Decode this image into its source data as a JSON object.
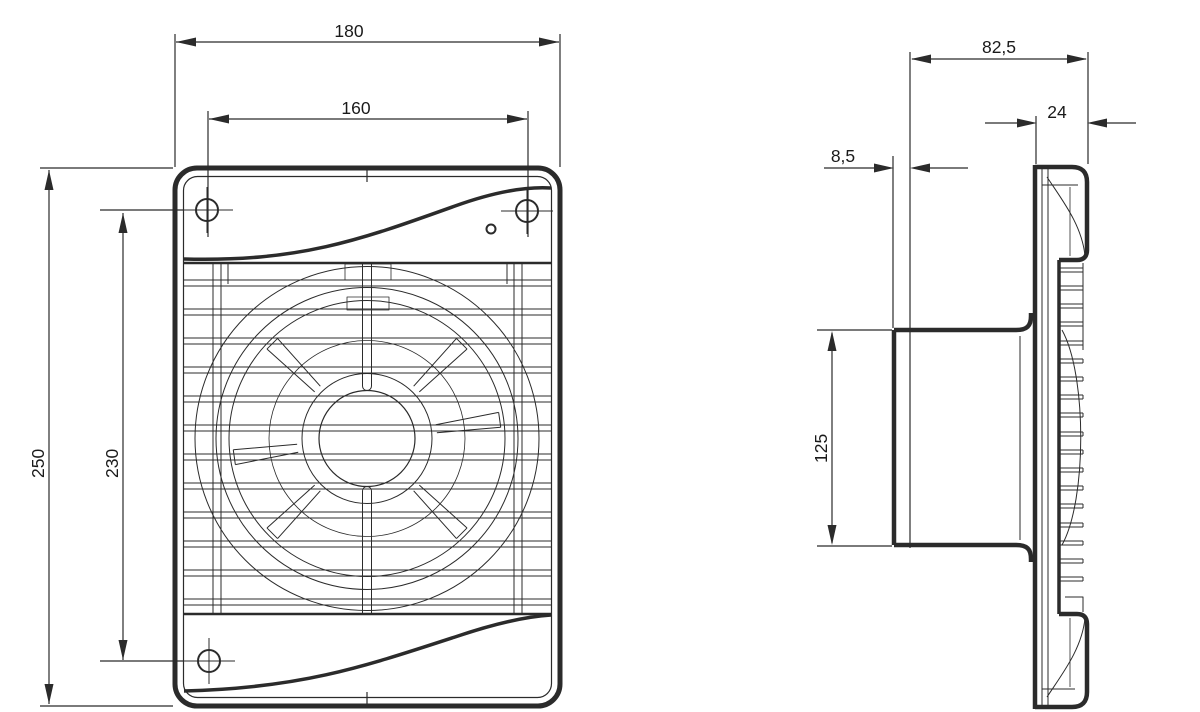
{
  "drawing": {
    "type": "technical-drawing",
    "subject": "axial-extract-fan",
    "background_color": "#ffffff",
    "line_color": "#2b2b2b",
    "front_view": {
      "dim_overall_width": "180",
      "dim_mounting_holes_horizontal": "160",
      "dim_overall_height": "250",
      "dim_mounting_holes_vertical": "230"
    },
    "side_view": {
      "dim_overall_depth": "82,5",
      "dim_front_panel_depth": "24",
      "dim_spigot_lip": "8,5",
      "dim_spigot_diameter": "125"
    }
  }
}
